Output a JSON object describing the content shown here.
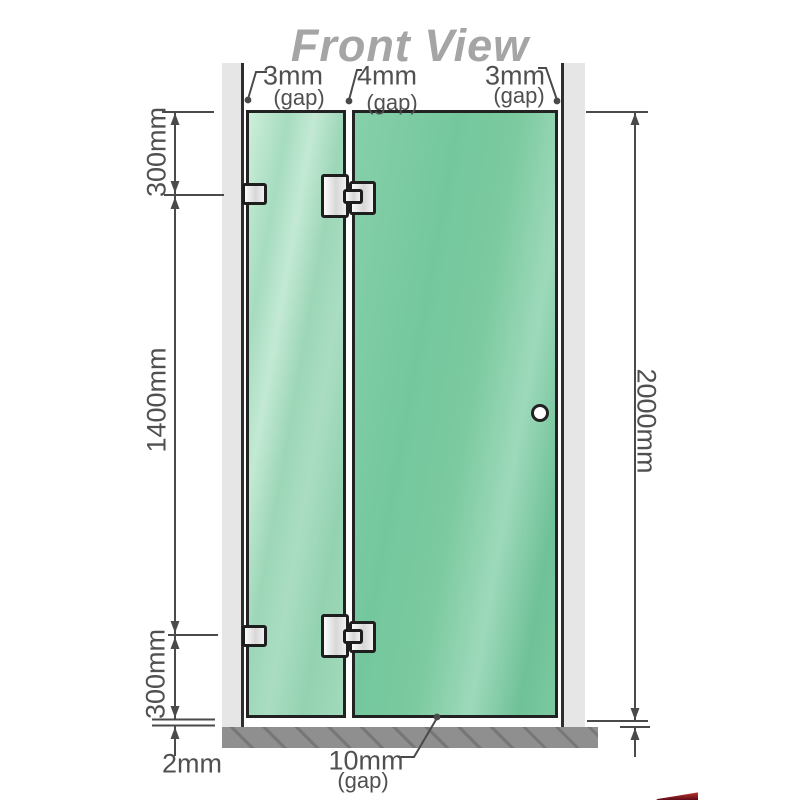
{
  "title": "Front View",
  "labels": {
    "gap_top_left": {
      "value": "3mm",
      "note": "(gap)"
    },
    "gap_top_middle": {
      "value": "4mm",
      "note": "(gap)"
    },
    "gap_top_right": {
      "value": "3mm",
      "note": "(gap)"
    },
    "segment_top": "300mm",
    "segment_middle": "1400mm",
    "segment_bottom": "300mm",
    "total_height": "2000mm",
    "floor_gap": "2mm",
    "door_bottom_gap": {
      "value": "10mm",
      "note": "(gap)"
    }
  },
  "colors": {
    "title_text": "#a5a5a5",
    "dimension_text": "#505050",
    "dimension_line": "#4a4a4a",
    "glass_fixed_panel": "#a6dcc0",
    "glass_door_panel": "#7ac9a1",
    "wall": "#e6e6e6",
    "base": "#8f8f8f",
    "outline": "#222222",
    "logo_red": "#8c1325"
  }
}
